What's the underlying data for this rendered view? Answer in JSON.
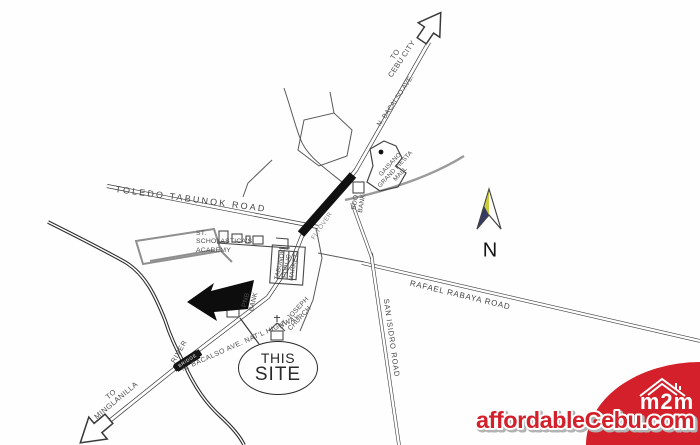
{
  "map": {
    "labels": {
      "to_cebu_city": "TO\nCEBU CITY",
      "n_bacalso_ave": "N. BACALSO AVE.",
      "gaisano_mall": "GAISANO\nGRAND FIESTA\nMALL",
      "bdo_bank": "BDO\nBANK",
      "flyover": "FLYOVER",
      "toledo_tabunok_road": "TOLEDO TABUNOK ROAD",
      "st_scholasticas_academy": "ST.\nSCHOLASTICA'S\nACADEMY",
      "tabunok_public_market": "TABUNOK\nPUBLIC\nMARKET",
      "pnb_bank": "PNB\nBANK",
      "st_joseph_church": "ST. JOSEPH\nCHURCH",
      "natl_highway": "N. BACALSO AVE.  NAT'L HIGHWAY",
      "rafael_rabaya_road": "RAFAEL RABAYA ROAD",
      "san_isidro_road": "SAN ISIDRO ROAD",
      "river": "RIVER",
      "bridge": "BRIDGE",
      "this_site_top": "THIS",
      "this_site_bottom": "SITE",
      "to_minglanilla": "TO\nMINGLANILLA",
      "north": "N"
    },
    "compass_colors": {
      "yellow": "#c9cb39",
      "navy": "#343a64"
    }
  },
  "watermark": {
    "text": "affordableCebu.com",
    "color": "#d3202a"
  },
  "logo": {
    "text": "m2m",
    "background": "#d3202a"
  }
}
